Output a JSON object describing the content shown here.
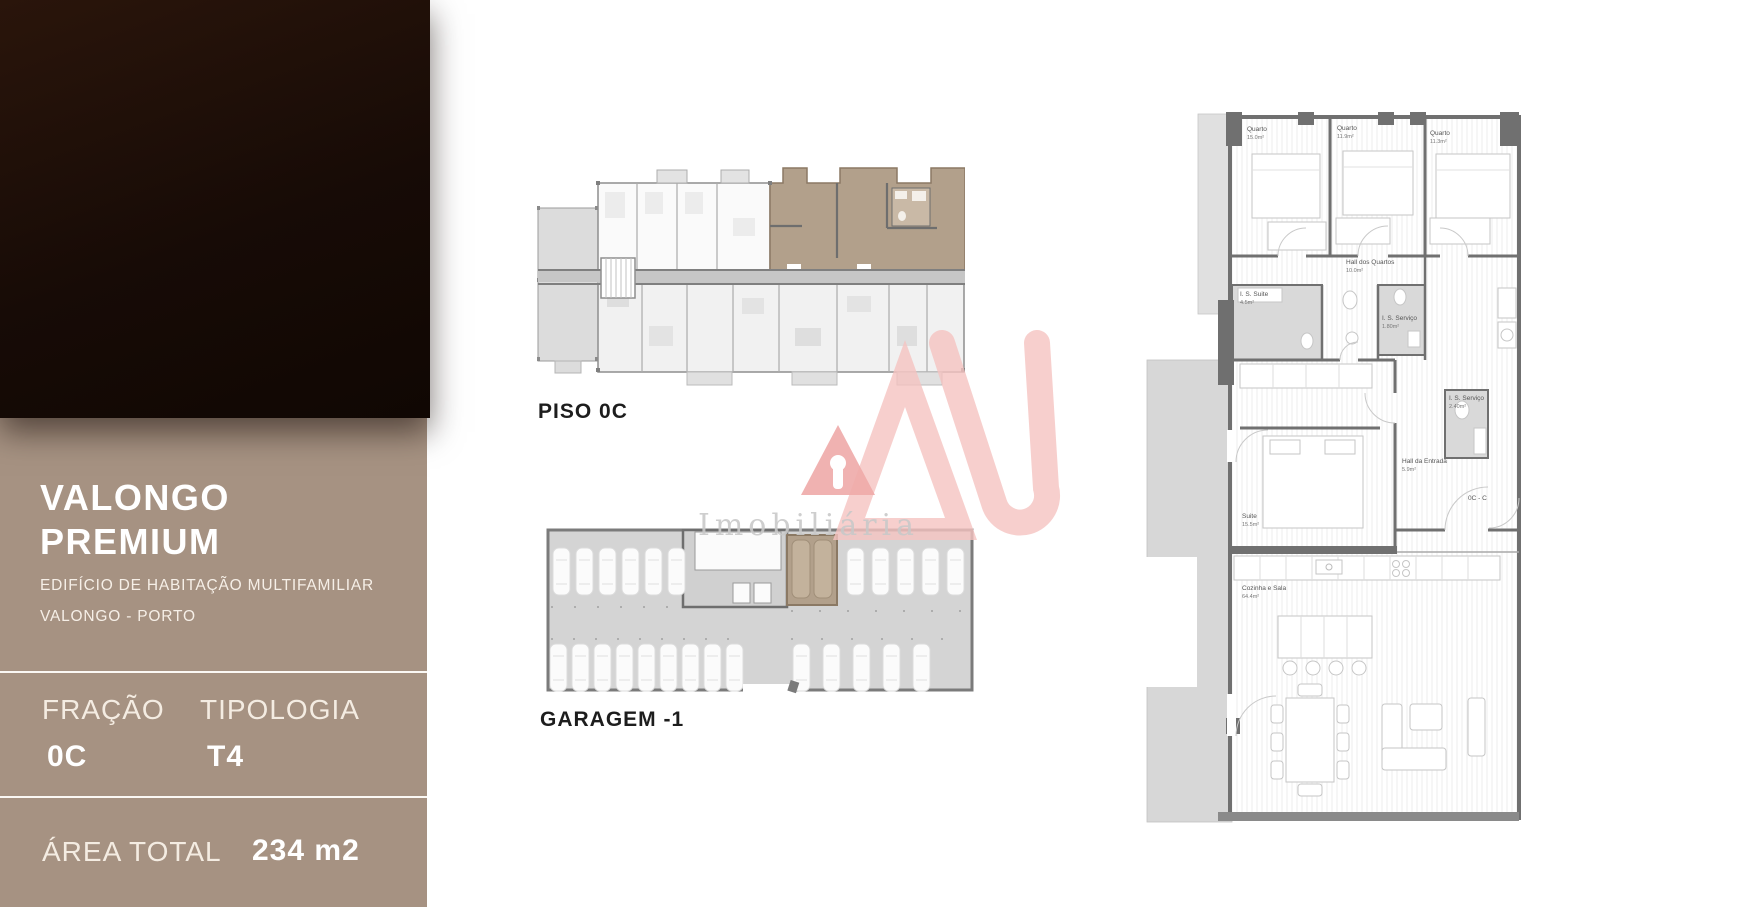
{
  "sidebar": {
    "title_line1": "VALONGO",
    "title_line2": "PREMIUM",
    "subtitle_line1": "EDIFÍCIO DE HABITAÇÃO MULTIFAMILIAR",
    "subtitle_line2": "VALONGO - PORTO",
    "fracao": {
      "label": "FRAÇÃO",
      "value": "0C"
    },
    "tipologia": {
      "label": "TIPOLOGIA",
      "value": "T4"
    },
    "area": {
      "label": "ÁREA TOTAL",
      "value": "234 m2"
    },
    "colors": {
      "panel": "#a69282",
      "dark_block": "#170b06",
      "text": "#ffffff"
    }
  },
  "plans": {
    "piso": {
      "label": "PISO 0C"
    },
    "garagem": {
      "label": "GARAGEM -1"
    },
    "highlight_color": "#b2a08b",
    "floor_gray": "#d4d4d4"
  },
  "apartment": {
    "rooms": {
      "quarto1": {
        "name": "Quarto",
        "area": "15.0m²"
      },
      "quarto2": {
        "name": "Quarto",
        "area": "11.9m²"
      },
      "quarto3": {
        "name": "Quarto",
        "area": "11.3m²"
      },
      "hall_quartos": {
        "name": "Hall dos Quartos",
        "area": "10.0m²"
      },
      "is_suite": {
        "name": "I. S. Suite",
        "area": "4.5m²"
      },
      "is_servico_1": {
        "name": "I. S. Serviço",
        "area": "1.80m²"
      },
      "suite": {
        "name": "Suite",
        "area": "15.5m²"
      },
      "hall_entrada": {
        "name": "Hall da Entrada",
        "area": "5.9m²"
      },
      "is_servico_2": {
        "name": "I. S. Serviço",
        "area": "2.40m²"
      },
      "cozinha_sala": {
        "name": "Cozinha e Sala",
        "area": "64.4m²"
      },
      "entrada_tag": "0C - C"
    }
  },
  "watermark": {
    "brand_text": "Imobiliária",
    "logo_color": "#f5c3c0"
  }
}
